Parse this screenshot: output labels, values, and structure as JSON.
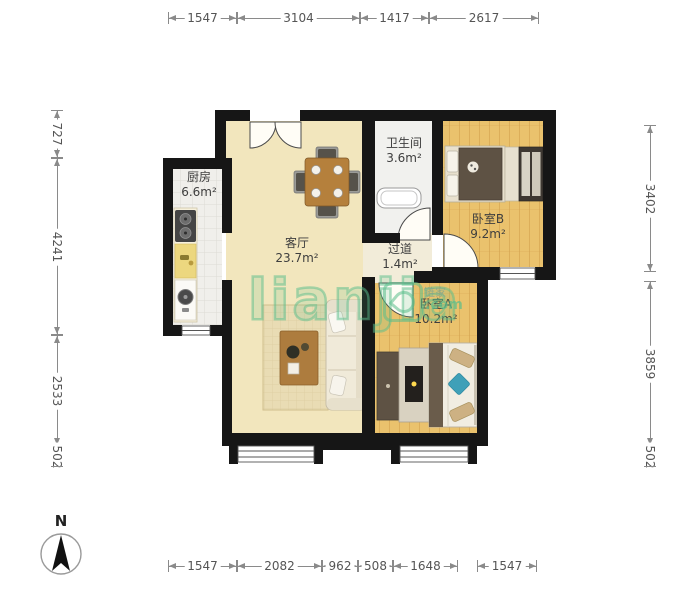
{
  "rooms": {
    "kitchen": {
      "name": "厨房",
      "area": "6.6m²"
    },
    "living": {
      "name": "客厅",
      "area": "23.7m²"
    },
    "bathroom": {
      "name": "卫生间",
      "area": "3.6m²"
    },
    "hallway": {
      "name": "过道",
      "area": "1.4m²"
    },
    "bedroomB": {
      "name": "卧室B",
      "area": "9.2m²"
    },
    "bedroomA": {
      "name": "卧室A",
      "area": "10.2m²"
    }
  },
  "dimensions": {
    "top": [
      "1547",
      "3104",
      "1417",
      "2617"
    ],
    "bottom": [
      "1547",
      "2082",
      "962",
      "508",
      "1648",
      "1547"
    ],
    "left": [
      "727",
      "4241",
      "2533",
      "502"
    ],
    "right": [
      "3402",
      "3859",
      "502"
    ]
  },
  "compass": {
    "label": "N"
  },
  "watermark": {
    "brand": "lianjia",
    "brand_cn": "链家",
    "domain": ".com"
  },
  "colors": {
    "wall": "#161616",
    "living_floor": "#f2e6bd",
    "wood_floor": "#eac26d",
    "kitchen_floor": "#f0efeb",
    "bathroom_floor": "#f1f1ee",
    "watermark_green": "#5abd8b",
    "dimension_line": "#8a8a8a"
  }
}
